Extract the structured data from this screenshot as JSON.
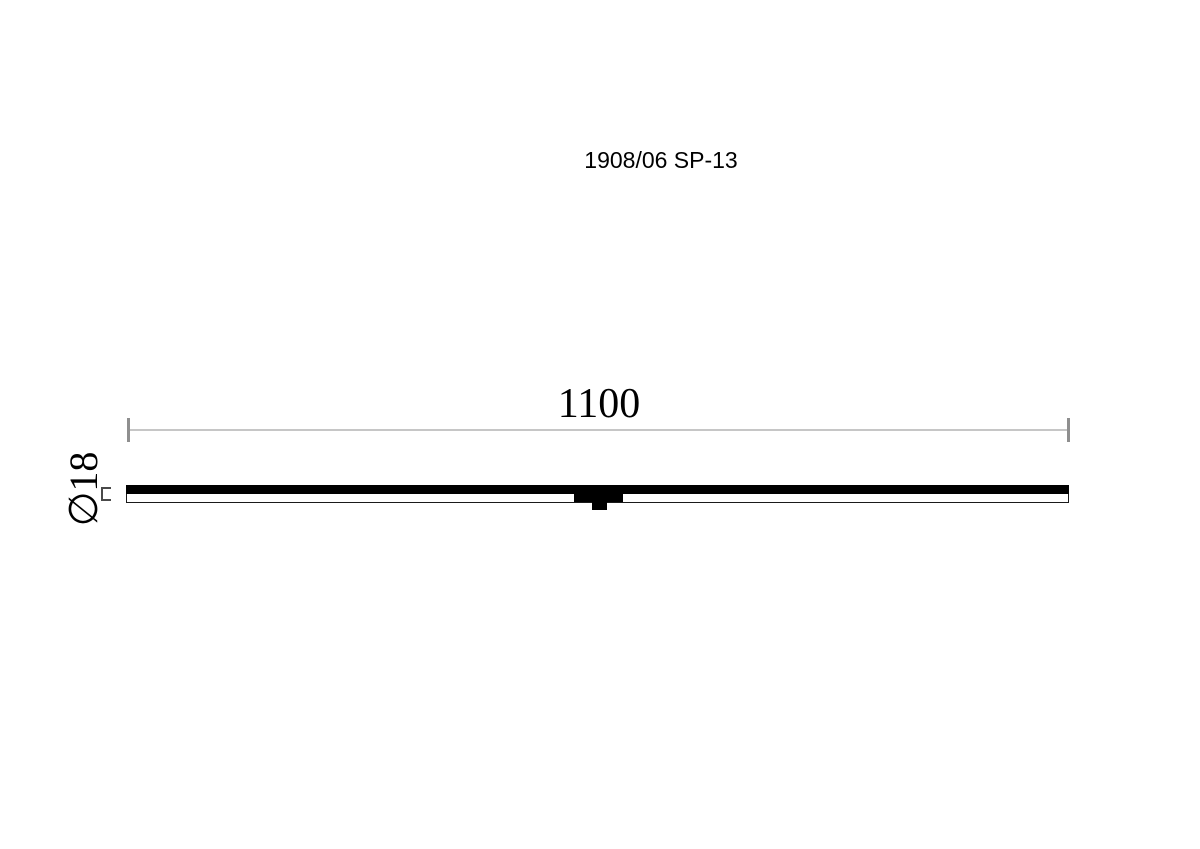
{
  "drawing": {
    "title": "1908/06 SP-13",
    "length_dimension_label": "1100",
    "diameter_dimension_label": "∅18",
    "colors": {
      "background": "#ffffff",
      "text": "#000000",
      "part_fill": "#000000",
      "part_outline": "#1a1a1a",
      "dimension_line": "#c6c6c6",
      "dimension_tick": "#8f8f8f",
      "diameter_marks": "#4a4a4a"
    }
  }
}
